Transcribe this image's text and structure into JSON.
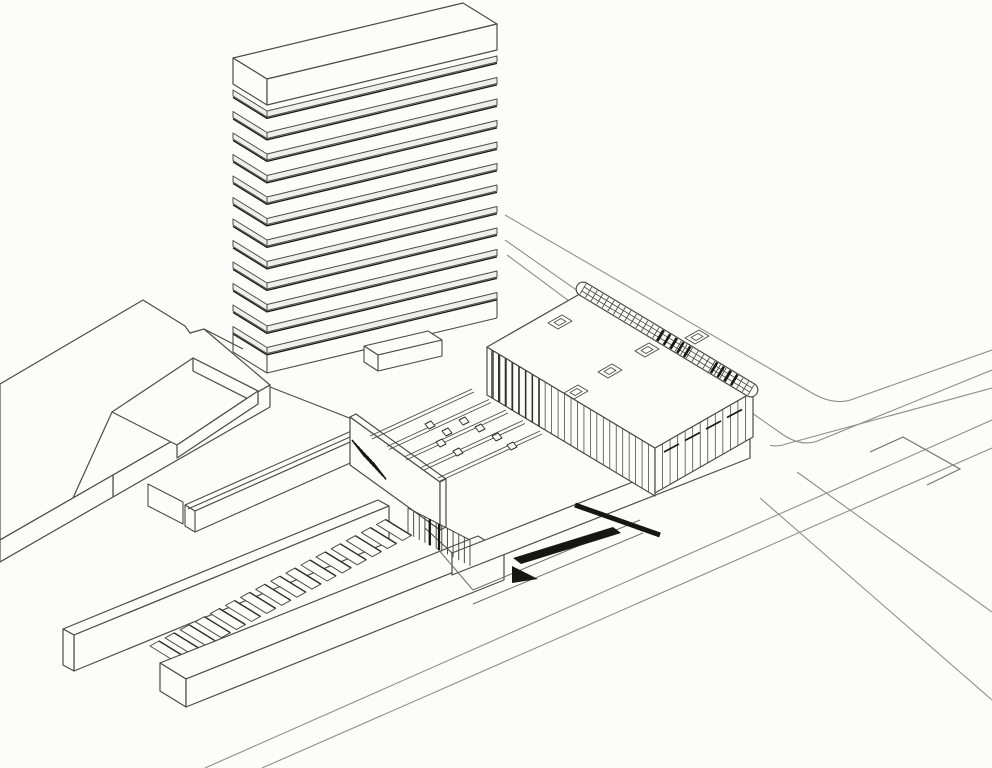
{
  "meta": {
    "title": "Axonometric architectural site drawing: banded slab tower, low exhibition hall with edge truss, courtyard building, long walled stair and street intersection",
    "drawing_type": "black-and-white scanned line drawing",
    "visible_text": ""
  },
  "palette": {
    "background": "#fcfcfa",
    "line": "#4b4b47",
    "line_light": "#8f8f89",
    "line_dark": "#2e2e2a",
    "shadow": "#161614",
    "band_fill": "#efefeb"
  },
  "elements": {
    "tower": {
      "name": "slab-tower",
      "floor_bands": 12,
      "has_roof_cap": true
    },
    "hall": {
      "name": "exhibition-hall",
      "rooflights": 5,
      "truss_ticks": 30,
      "dark_truss_ticks": 9,
      "mullions_front": 25,
      "mullions_end": 12,
      "dark_mullions": 8,
      "end_brace_ticks": 4
    },
    "terrace": {
      "name": "plinth-terrace",
      "skylight_strips": 5,
      "vent_marks": 8
    },
    "stair": {
      "name": "walled-stair",
      "steps": 16
    },
    "underplinth": {
      "colonnade_lines": 12,
      "dark_hatch_strokes": 8
    },
    "courtyard_building": {
      "name": "courtyard-building",
      "has_sunken_court": true
    },
    "streets": {
      "curb_lines_ne": 3,
      "curb_lines_bottom": 2,
      "curb_lines_right": 2,
      "has_corner_marking": true
    }
  }
}
